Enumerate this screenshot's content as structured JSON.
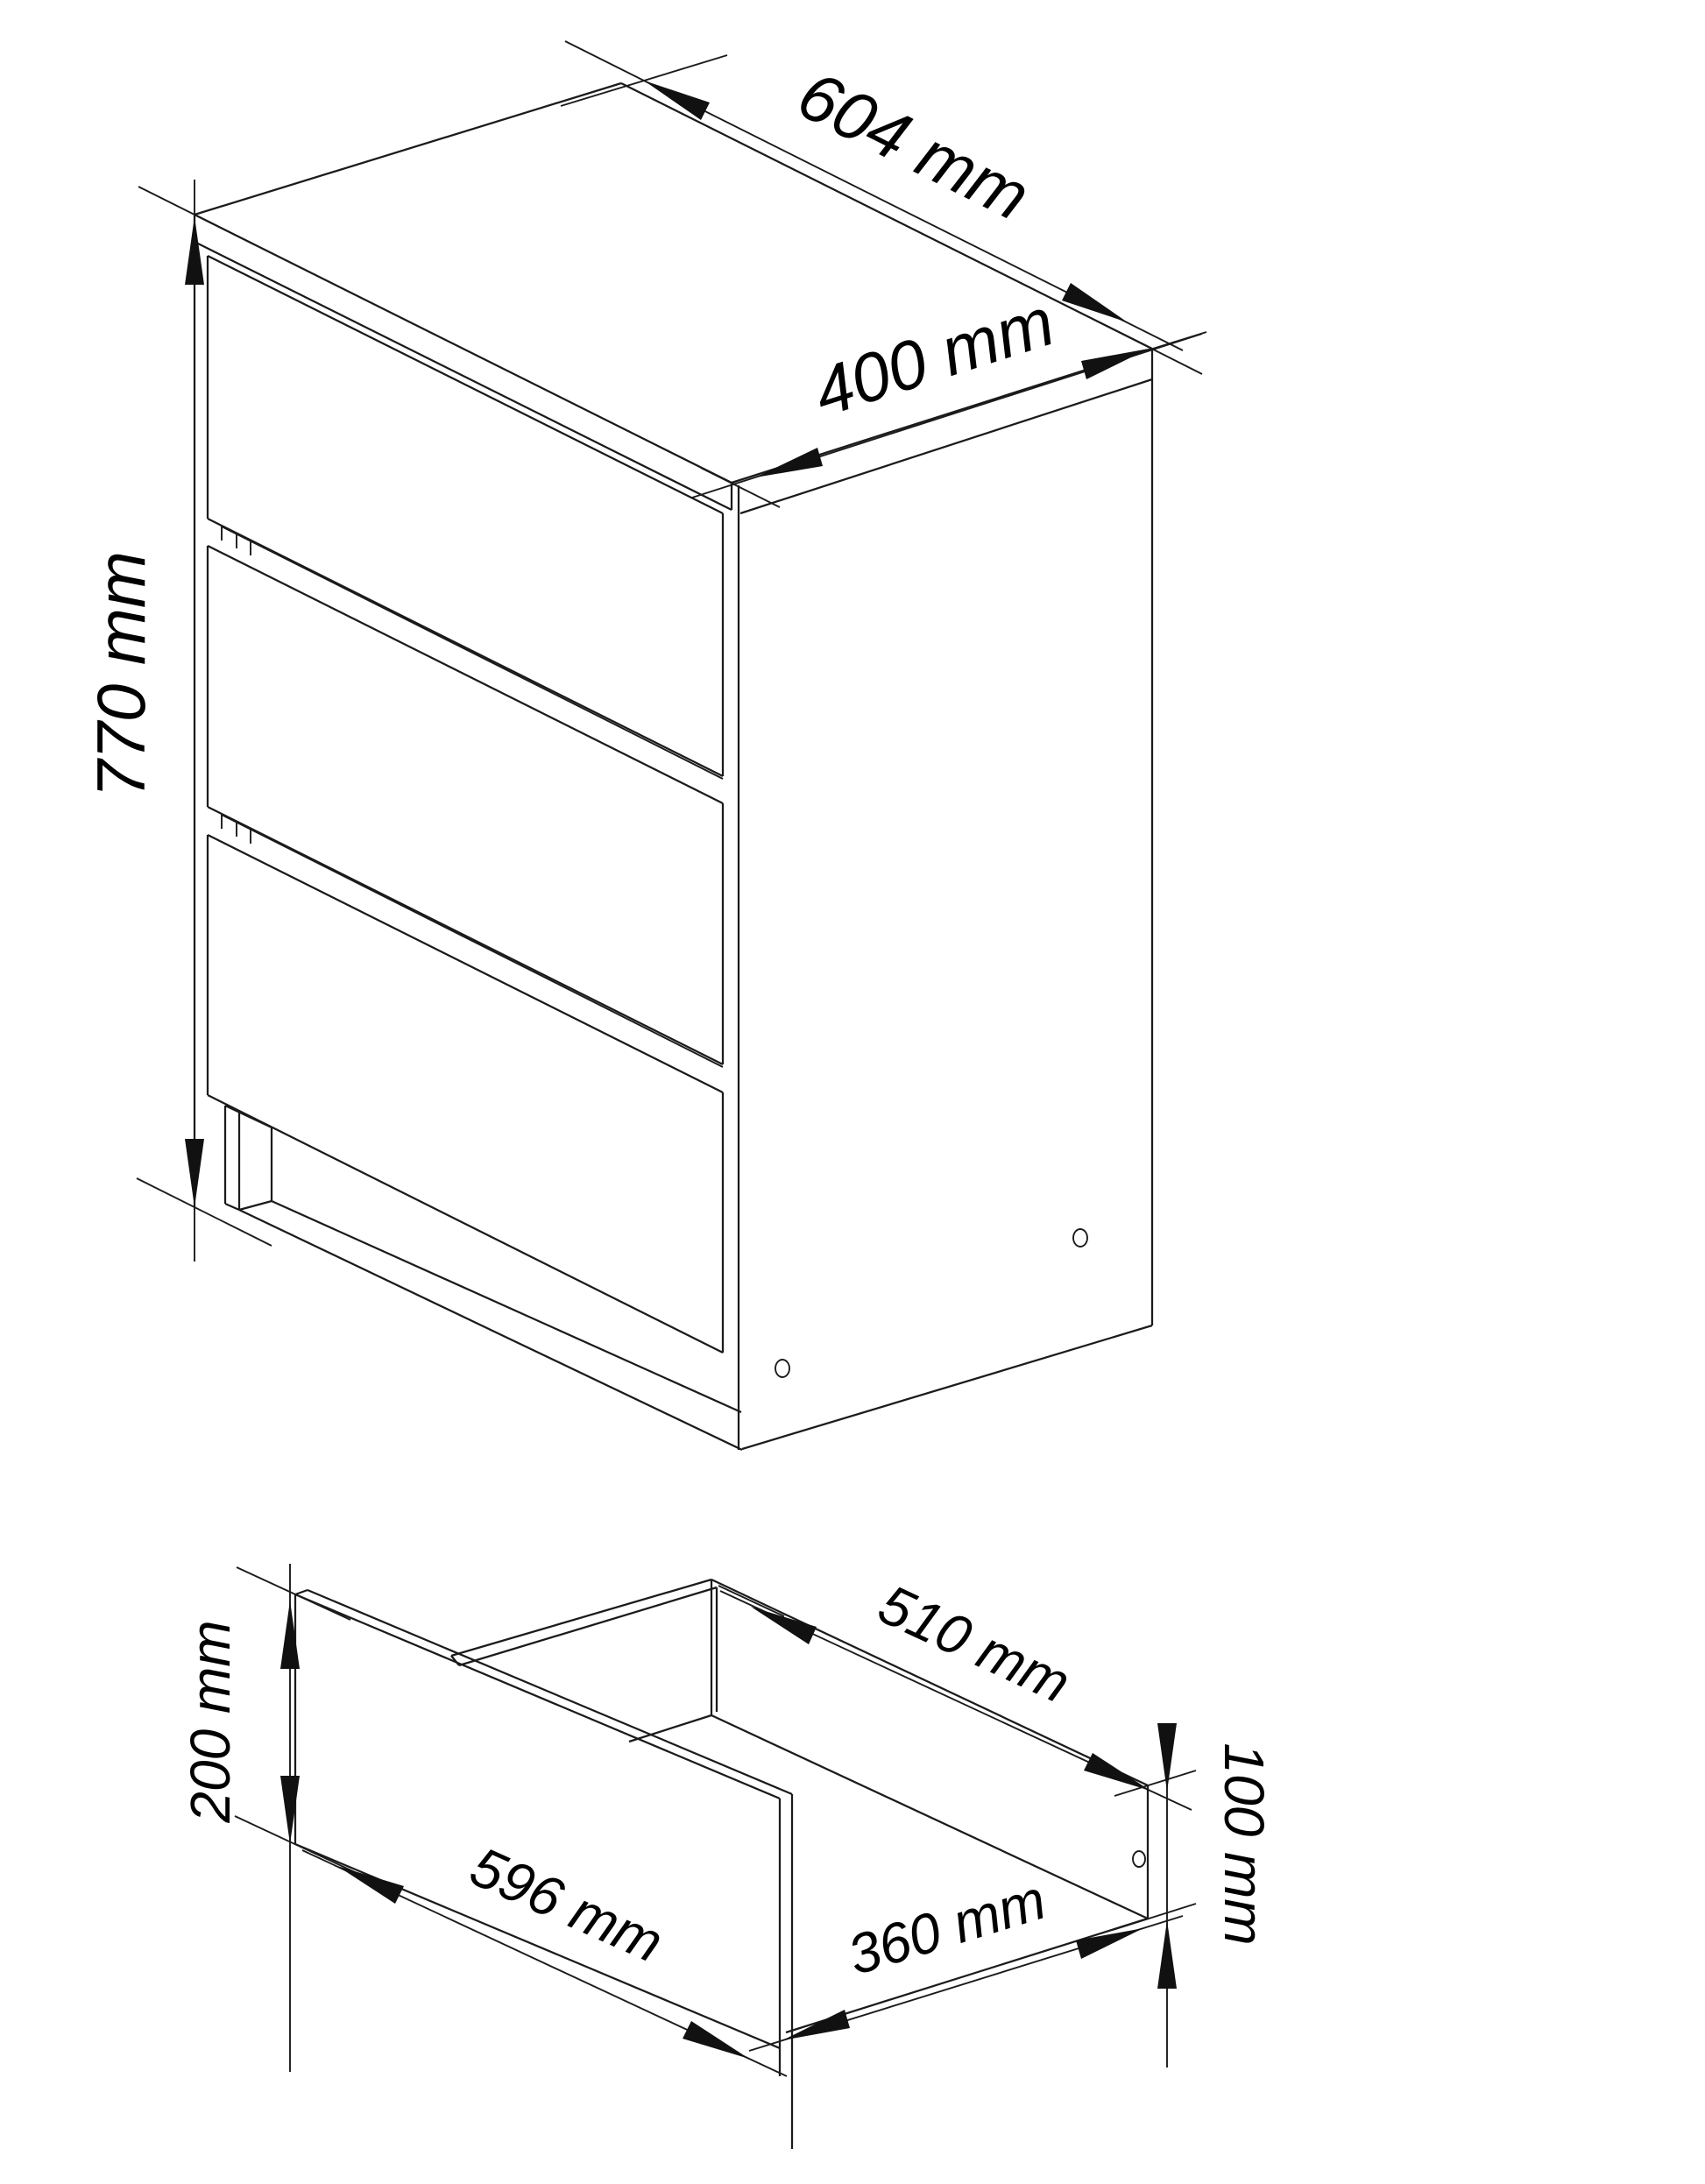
{
  "page": {
    "background": "#ffffff",
    "kind": "furniture technical drawing"
  },
  "style": {
    "line_color": "#1b1b1b",
    "text_color": "#000000"
  },
  "views": {
    "cabinet": {
      "title": "chest of drawers - 3 drawer isometric view",
      "drawer_count": 3,
      "side_hole_count": 2,
      "dimensions": {
        "width": {
          "value": 604,
          "unit": "mm",
          "label": "604 mm"
        },
        "depth": {
          "value": 400,
          "unit": "mm",
          "label": "400 mm"
        },
        "height": {
          "value": 770,
          "unit": "mm",
          "label": "770 mm"
        }
      }
    },
    "drawer": {
      "title": "single drawer isometric detail",
      "side_hole_count": 1,
      "dimensions": {
        "front_height": {
          "value": 200,
          "unit": "mm",
          "label": "200 mm"
        },
        "front_width": {
          "value": 596,
          "unit": "mm",
          "label": "596 mm"
        },
        "side_depth": {
          "value": 510,
          "unit": "mm",
          "label": "510 mm"
        },
        "bottom_depth": {
          "value": 360,
          "unit": "mm",
          "label": "360 mm"
        },
        "side_height": {
          "value": 100,
          "unit": "mm",
          "label": "100 mm"
        }
      }
    }
  }
}
